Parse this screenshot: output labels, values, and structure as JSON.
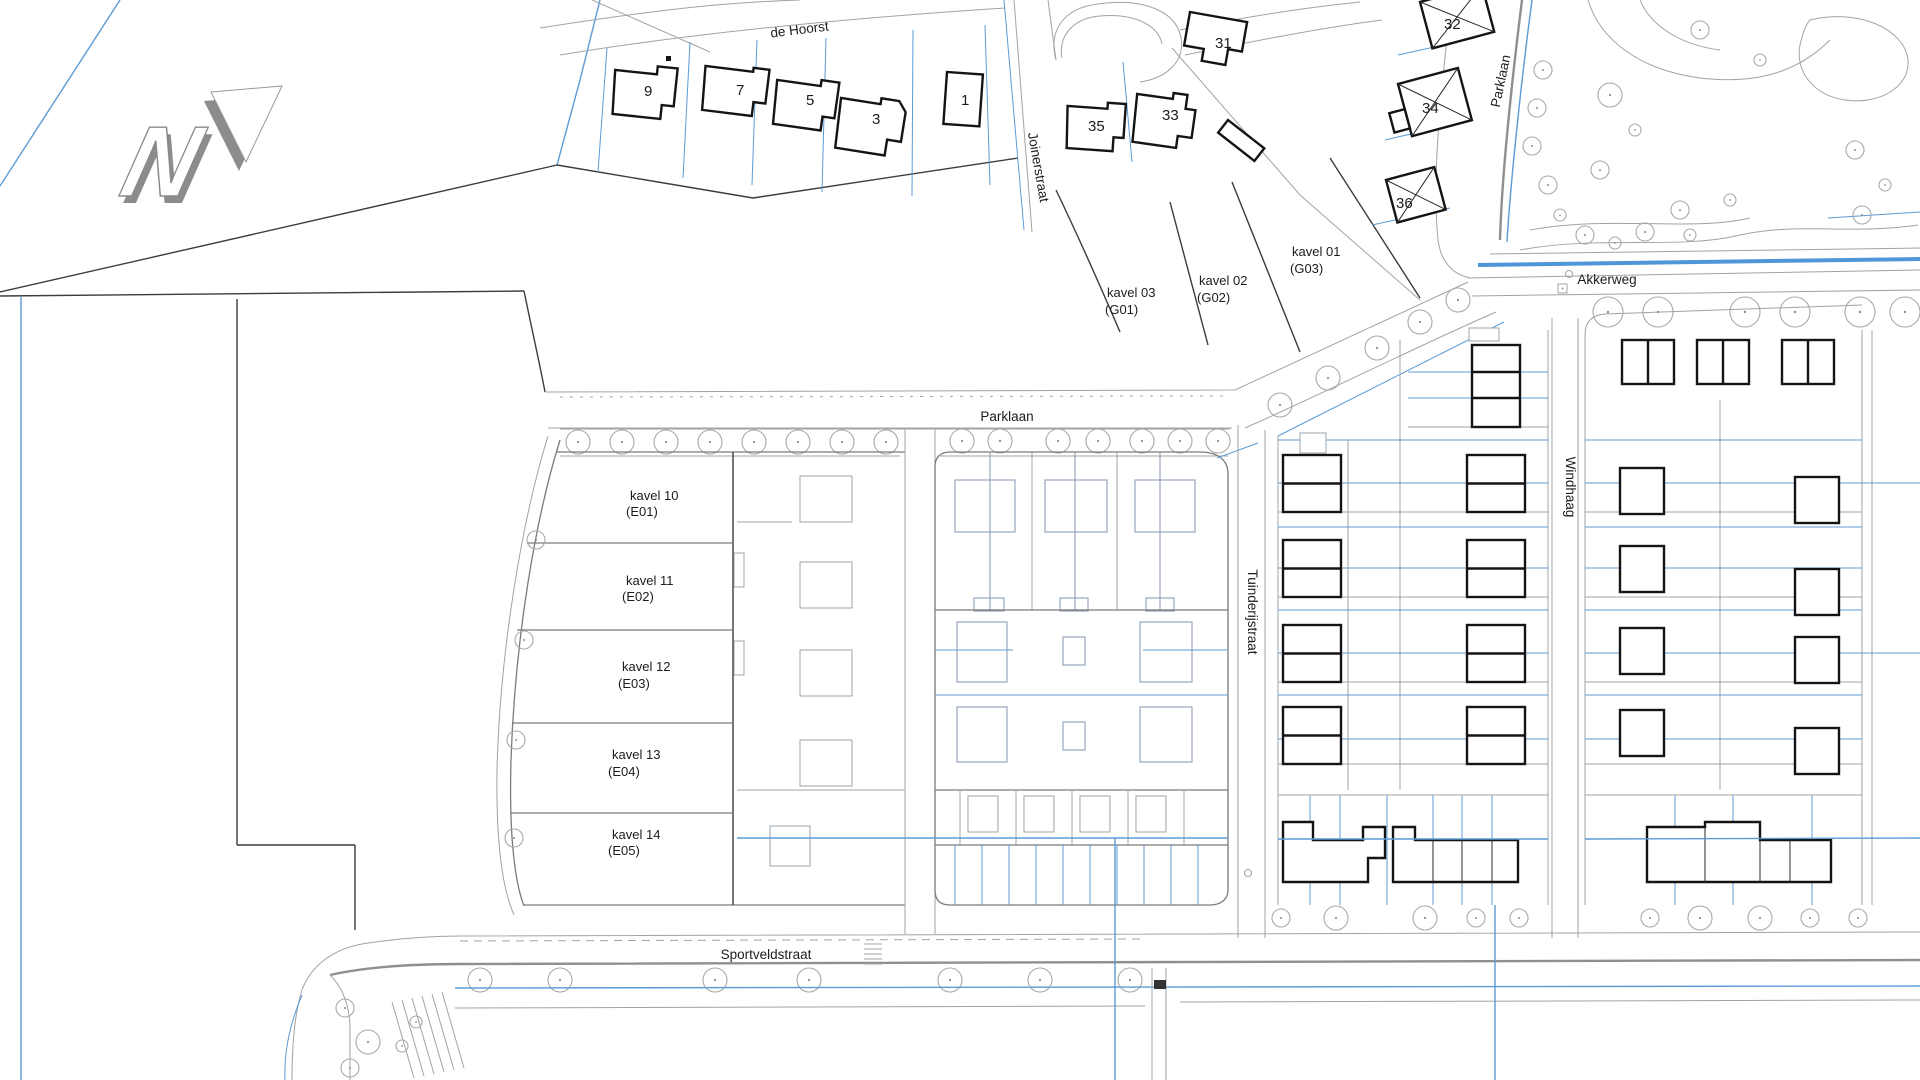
{
  "labels": {
    "north_letter": "N",
    "de_hoorst": "de Hoorst",
    "joinerstraat": "Joinerstraat",
    "parklaan_main": "Parklaan",
    "parklaan_north": "Parklaan",
    "akkerweg": "Akkerweg",
    "tuinderijstraat": "Tuinderijstraat",
    "windhaag": "Windhaag",
    "sportveldstraat": "Sportveldstraat"
  },
  "house_numbers": {
    "h1": "1",
    "h3": "3",
    "h5": "5",
    "h7": "7",
    "h9": "9",
    "h31": "31",
    "h32": "32",
    "h33": "33",
    "h34": "34",
    "h35": "35",
    "h36": "36"
  },
  "kavels": {
    "k01_name": "kavel 01",
    "k01_code": "(G03)",
    "k02_name": "kavel 02",
    "k02_code": "(G02)",
    "k03_name": "kavel 03",
    "k03_code": "(G01)",
    "k10_name": "kavel 10",
    "k10_code": "(E01)",
    "k11_name": "kavel 11",
    "k11_code": "(E02)",
    "k12_name": "kavel 12",
    "k12_code": "(E03)",
    "k13_name": "kavel 13",
    "k13_code": "(E04)",
    "k14_name": "kavel 14",
    "k14_code": "(E05)"
  },
  "colors": {
    "parcel_line": "#5b9bd5",
    "water_line": "#4f96d8",
    "road_line": "#9a9a9a",
    "existing_building": "#141414",
    "planned_building": "#9aa4ad",
    "text": "#1c1c1c",
    "north_arrow_shadow": "#8c8c8c"
  }
}
